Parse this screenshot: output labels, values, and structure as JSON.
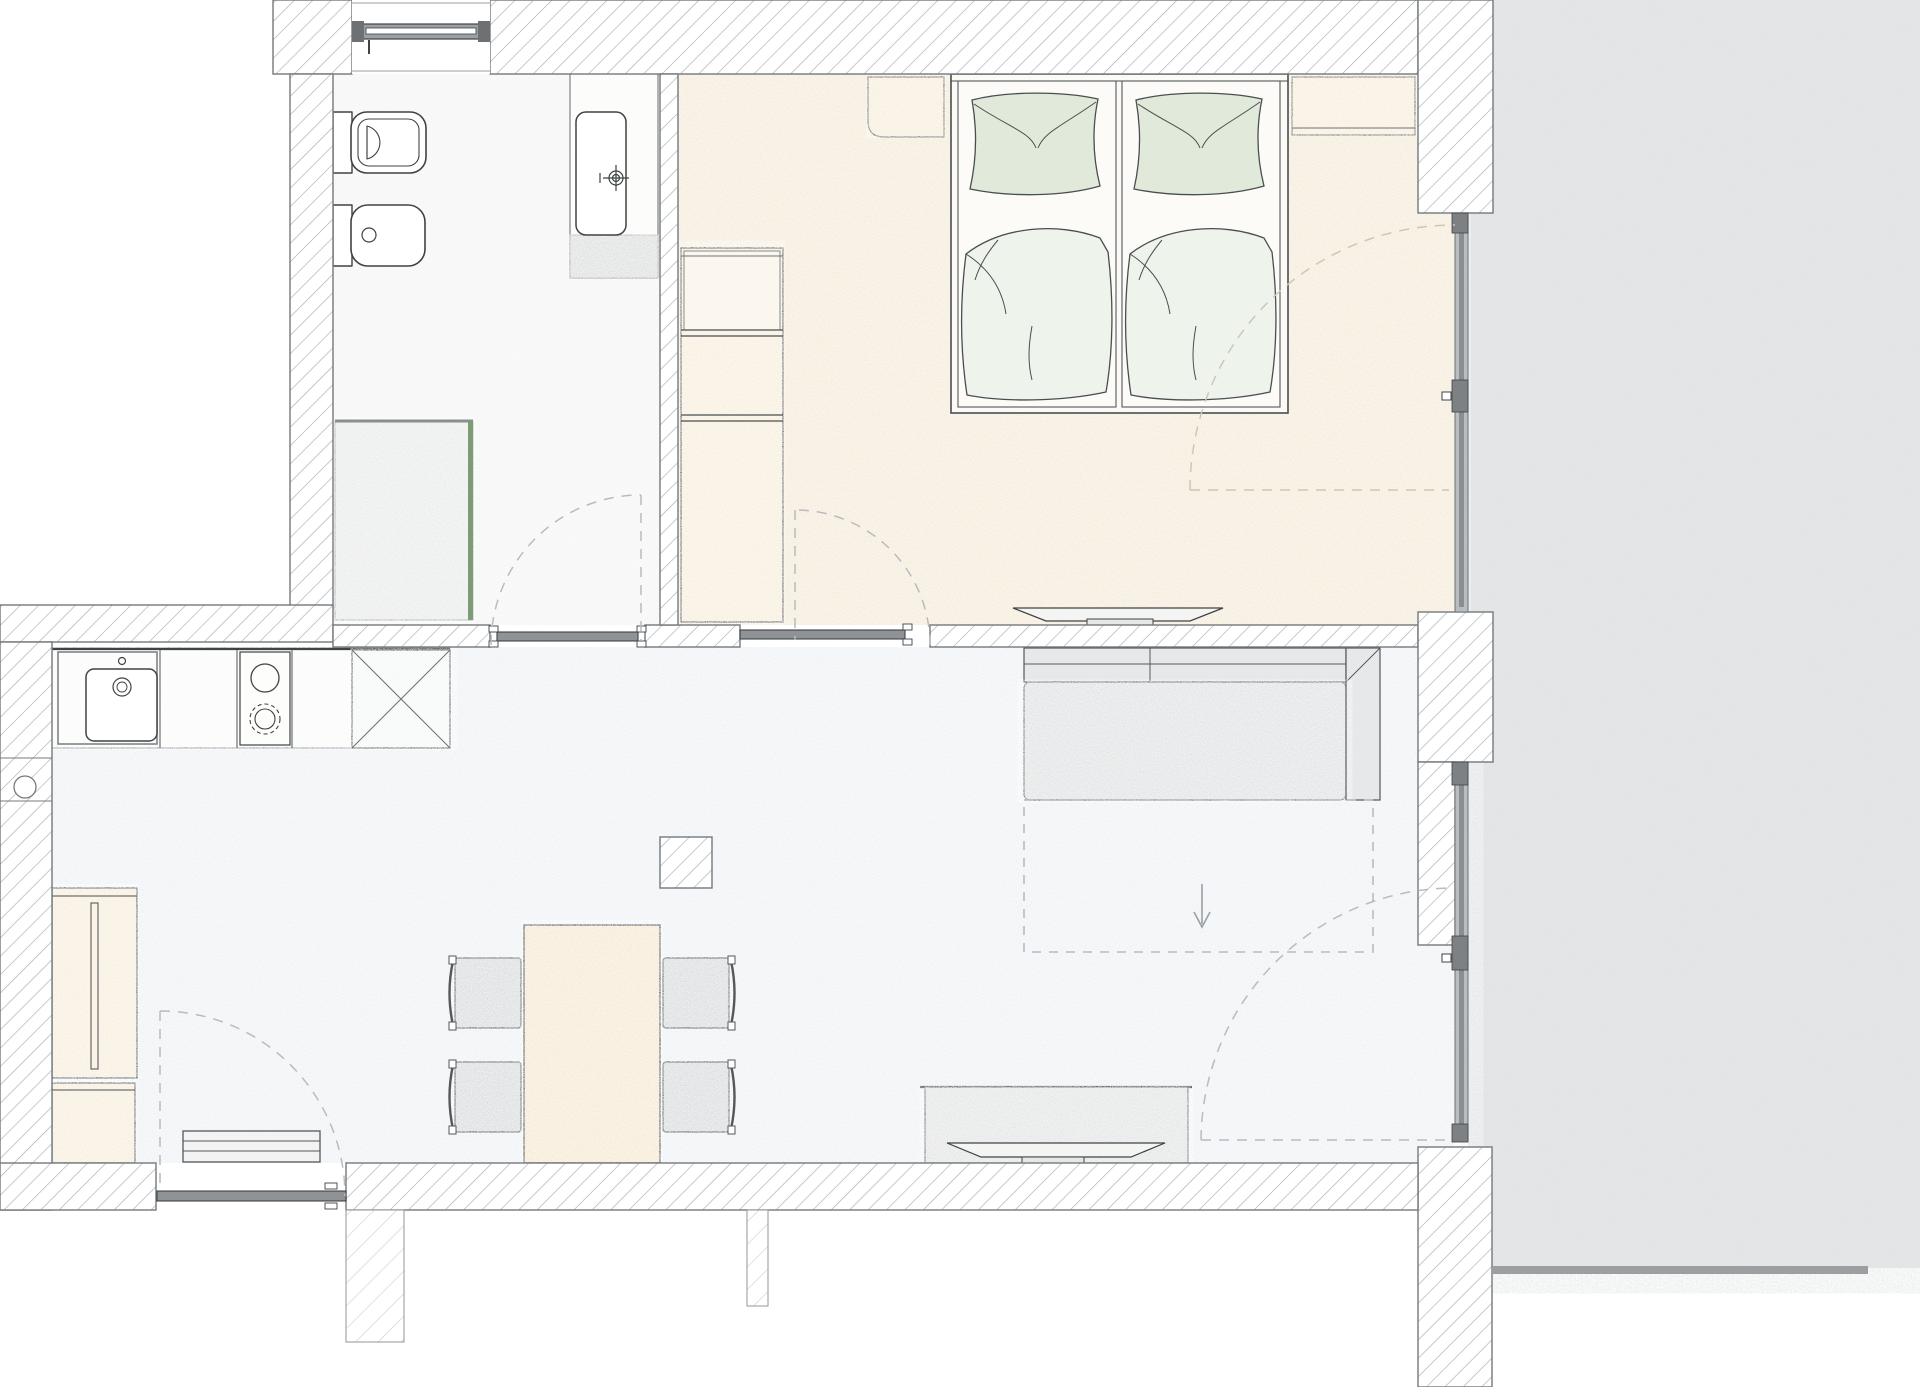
{
  "meta": {
    "title": "Apartment floor plan — top view architectural drawing",
    "drawing_type": "floor-plan",
    "text_on_image": "none"
  },
  "colors": {
    "wall_hatch": "#a9aeb1",
    "wall_outline": "#74797c",
    "ink": "#3f4345",
    "floor_living": "#eef2f5",
    "floor_bedroom": "#f4ead7",
    "floor_bathroom": "#f4f5f4",
    "terrace": "#e1e3e4",
    "terrace_edge": "#9b9fa1",
    "beige": "#f7edda",
    "table_beige": "#f5e8cf",
    "gray_furniture": "#d8dadb",
    "sofa_gray": "#e7e8e9",
    "seat_gray": "#dfe1e2",
    "sideboard_gray": "#e2e3e4",
    "pillow_green": "#e0e9da",
    "duvet_green": "#eef3ec",
    "shower_glass": "#7d9b74",
    "shower_floor": "#e9eaea",
    "door_leaf": "#8f9395",
    "glass_frame": "#9aa0a3",
    "dash": "#b7bcbf"
  },
  "rooms": [
    {
      "id": "bathroom",
      "label": "Bathroom",
      "fixtures": [
        "toilet",
        "bidet",
        "shower with glass panel",
        "vanity with sink",
        "window"
      ]
    },
    {
      "id": "bedroom",
      "label": "Bedroom",
      "furniture": [
        "double bed (2 mattresses, 2 pillows, 2 duvets)",
        "nightstand left",
        "nightstand right",
        "wardrobe with shelves",
        "wall TV"
      ]
    },
    {
      "id": "living-kitchen",
      "label": "Living room / Kitchen",
      "furniture": [
        "kitchen counter",
        "sink",
        "cooktop 2 burners",
        "appliance (X unit)",
        "tall fridge unit",
        "base cabinet",
        "radiator/door-mat",
        "dining table",
        "4 chairs",
        "structural column",
        "sofa with chaise",
        "rug (dashed) with arrow",
        "sideboard with TV"
      ]
    },
    {
      "id": "terrace",
      "label": "Terrace / exterior paving"
    }
  ],
  "openings": {
    "doors": [
      {
        "id": "bathroom-door",
        "location": "middle wall",
        "swing": "into bathroom"
      },
      {
        "id": "bedroom-door",
        "location": "middle wall",
        "swing": "into bedroom"
      },
      {
        "id": "entrance-door",
        "location": "bottom wall",
        "swing": "into living room"
      },
      {
        "id": "bedroom-terrace-door",
        "location": "right glass front",
        "swing": "into bedroom"
      },
      {
        "id": "living-terrace-door",
        "location": "right glass front",
        "swing": "into living room"
      }
    ],
    "windows": [
      {
        "id": "bathroom-window",
        "location": "top wall"
      },
      {
        "id": "glass-front-bedroom",
        "location": "right wall"
      },
      {
        "id": "glass-front-living",
        "location": "right wall"
      }
    ]
  }
}
